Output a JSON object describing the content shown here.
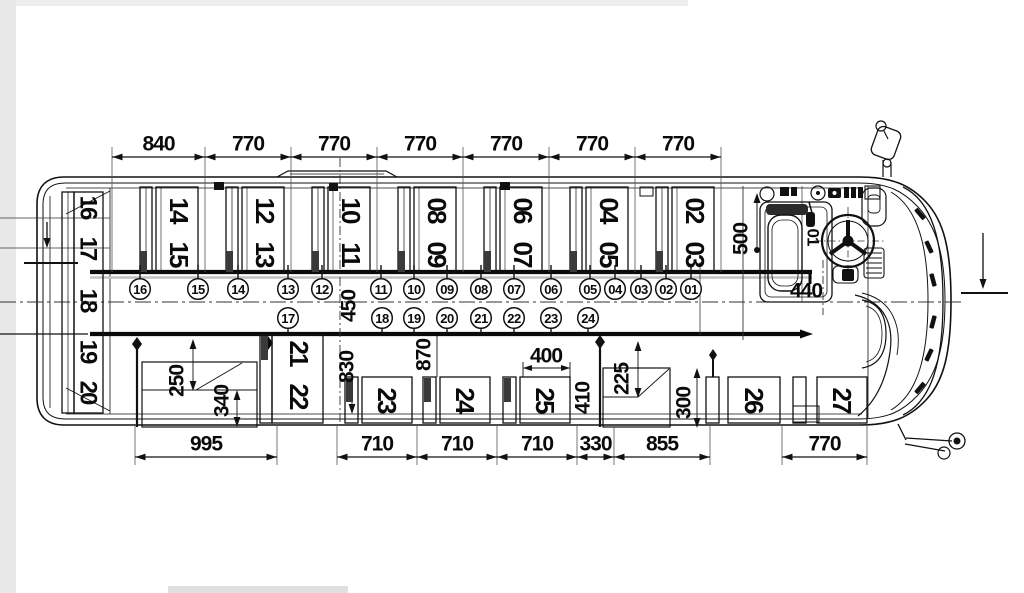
{
  "diagram": {
    "type": "bus-seating-floor-plan-top-view",
    "units": "mm",
    "driver_seat_label": "01",
    "top_dimension_chain": {
      "y": 157,
      "items": [
        {
          "label": "840",
          "x1": 112,
          "x2": 205
        },
        {
          "label": "770",
          "x1": 205,
          "x2": 291
        },
        {
          "label": "770",
          "x1": 291,
          "x2": 377
        },
        {
          "label": "770",
          "x1": 377,
          "x2": 463
        },
        {
          "label": "770",
          "x1": 463,
          "x2": 549
        },
        {
          "label": "770",
          "x1": 549,
          "x2": 635
        },
        {
          "label": "770",
          "x1": 635,
          "x2": 721
        }
      ]
    },
    "bottom_dimension_chain": {
      "y": 457,
      "items": [
        {
          "label": "995",
          "x1": 135,
          "x2": 277
        },
        {
          "label": "710",
          "x1": 337,
          "x2": 417
        },
        {
          "label": "710",
          "x1": 417,
          "x2": 497
        },
        {
          "label": "710",
          "x1": 497,
          "x2": 577
        },
        {
          "label": "330",
          "x1": 577,
          "x2": 614
        },
        {
          "label": "855",
          "x1": 614,
          "x2": 710
        },
        {
          "label": "770",
          "x1": 782,
          "x2": 867
        }
      ]
    },
    "vertical_dimensions": [
      {
        "label": "500",
        "x": 741,
        "y": 239
      },
      {
        "label": "440",
        "x": 806,
        "y": 291,
        "horizontal": true
      },
      {
        "label": "450",
        "x": 349,
        "y": 306
      },
      {
        "label": "830",
        "x": 347,
        "y": 367
      },
      {
        "label": "870",
        "x": 424,
        "y": 355
      },
      {
        "label": "400",
        "x": 546,
        "y": 356,
        "horizontal": true
      },
      {
        "label": "410",
        "x": 583,
        "y": 398
      },
      {
        "label": "225",
        "x": 622,
        "y": 379
      },
      {
        "label": "300",
        "x": 684,
        "y": 403
      },
      {
        "label": "250",
        "x": 177,
        "y": 381
      },
      {
        "label": "340",
        "x": 222,
        "y": 401
      }
    ],
    "forward_bench_seats": [
      {
        "numbers": [
          "14",
          "15"
        ],
        "x": 140
      },
      {
        "numbers": [
          "12",
          "13"
        ],
        "x": 226
      },
      {
        "numbers": [
          "10",
          "11"
        ],
        "x": 312
      },
      {
        "numbers": [
          "08",
          "09"
        ],
        "x": 398
      },
      {
        "numbers": [
          "06",
          "07"
        ],
        "x": 484
      },
      {
        "numbers": [
          "04",
          "05"
        ],
        "x": 570
      },
      {
        "numbers": [
          "02",
          "03"
        ],
        "x": 656
      }
    ],
    "rear_bench": {
      "numbers": [
        "16",
        "17",
        "18",
        "19",
        "20"
      ],
      "x": 88,
      "ys": [
        207,
        248,
        300,
        351,
        392
      ]
    },
    "curbside_seats": [
      {
        "numbers": [
          [
            "21",
            299,
            353
          ],
          [
            "22",
            299,
            396
          ]
        ],
        "back": [
          260,
          335,
          12,
          88
        ],
        "cushion": [
          272,
          335,
          51,
          88
        ],
        "stub": [
          261,
          336
        ]
      },
      {
        "numbers": [
          [
            "23",
            387,
            400
          ]
        ],
        "back": [
          345,
          377,
          13,
          46
        ],
        "cushion": [
          362,
          377,
          50,
          46
        ],
        "stub": [
          346,
          378
        ]
      },
      {
        "numbers": [
          [
            "24",
            465,
            400
          ]
        ],
        "back": [
          423,
          377,
          13,
          46
        ],
        "cushion": [
          440,
          377,
          50,
          46
        ],
        "stub": [
          424,
          378
        ]
      },
      {
        "numbers": [
          [
            "25",
            545,
            400
          ]
        ],
        "back": [
          503,
          377,
          13,
          46
        ],
        "cushion": [
          520,
          377,
          50,
          46
        ],
        "stub": [
          504,
          378
        ]
      },
      {
        "numbers": [
          [
            "26",
            754,
            400
          ]
        ],
        "back": [
          706,
          377,
          13,
          46
        ],
        "cushion": [
          728,
          377,
          52,
          46
        ]
      },
      {
        "numbers": [
          [
            "27",
            842,
            400
          ]
        ],
        "back": [
          793,
          377,
          13,
          46
        ],
        "cushion": [
          817,
          377,
          50,
          46
        ]
      }
    ],
    "seat_markers_row1": {
      "y": 289,
      "items": [
        {
          "n": "16",
          "x": 140
        },
        {
          "n": "15",
          "x": 198
        },
        {
          "n": "14",
          "x": 238
        },
        {
          "n": "13",
          "x": 288
        },
        {
          "n": "12",
          "x": 322
        },
        {
          "n": "11",
          "x": 381
        },
        {
          "n": "10",
          "x": 414
        },
        {
          "n": "09",
          "x": 447
        },
        {
          "n": "08",
          "x": 481
        },
        {
          "n": "07",
          "x": 514
        },
        {
          "n": "06",
          "x": 551
        },
        {
          "n": "05",
          "x": 590
        },
        {
          "n": "04",
          "x": 615
        },
        {
          "n": "03",
          "x": 641
        },
        {
          "n": "02",
          "x": 666
        },
        {
          "n": "01",
          "x": 691
        }
      ]
    },
    "seat_markers_row2": {
      "y": 318,
      "items": [
        {
          "n": "17",
          "x": 288
        },
        {
          "n": "18",
          "x": 382
        },
        {
          "n": "19",
          "x": 414
        },
        {
          "n": "20",
          "x": 447
        },
        {
          "n": "21",
          "x": 481
        },
        {
          "n": "22",
          "x": 514
        },
        {
          "n": "23",
          "x": 551
        },
        {
          "n": "24",
          "x": 588
        }
      ]
    }
  }
}
